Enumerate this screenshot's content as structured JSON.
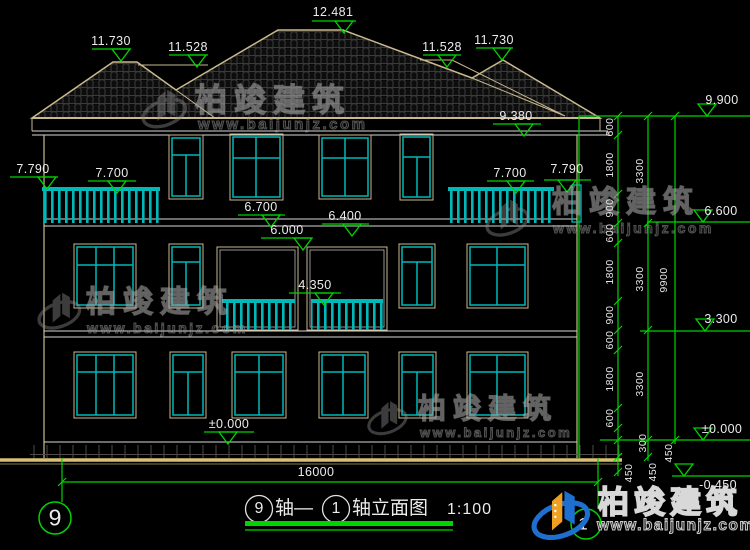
{
  "title_block": {
    "axis_left_bubble": "9",
    "axis_right_bubble": "1",
    "title_bubble_left": "9",
    "title_mid": "轴—",
    "title_bubble_right": "1",
    "title_suffix": "轴立面图",
    "scale": "1:100"
  },
  "dimensions": {
    "overall_width": "16000",
    "right_chain_inner": [
      "600",
      "1800",
      "900",
      "600",
      "1800",
      "900",
      "600",
      "1800",
      "600",
      "300"
    ],
    "right_chain_floors": [
      "3300",
      "3300",
      "3300"
    ],
    "right_chain_total": "9900",
    "below_zero": [
      "450",
      "450",
      "450"
    ]
  },
  "elevations": {
    "ridge": "12.481",
    "left_wing_ridge": "11.730",
    "left_upper_eave": "11.528",
    "right_upper_eave": "11.528",
    "right_wing_ridge": "11.730",
    "parapet_right": "9.900",
    "eave": "9.380",
    "balcony_left_rail": "7.790",
    "balcony_left_floor": "7.700",
    "balcony_right_floor": "7.700",
    "balcony_right_rail": "7.790",
    "window_sill_3f": "6.700",
    "beam_bottom_3f": "6.400",
    "floor_3f": "6.600",
    "lintel_2f": "6.000",
    "railing_2f": "4.350",
    "floor_2f": "3.300",
    "ground_floor_left": "±0.000",
    "ground_floor_right": "±0.000",
    "site_level": "-0.450"
  },
  "watermark": {
    "brand": "柏竣建筑",
    "url": "www.baijunjz.com"
  },
  "footer_logo": {
    "brand": "柏竣建筑",
    "url": "www.baijunjz.com"
  },
  "colors": {
    "background": "#000000",
    "outline_tan": "#c9b98c",
    "window_cyan": "#00b8b8",
    "dimension_green": "#00d400",
    "text_white": "#ececec",
    "ground_tan": "#d8c070",
    "logo_blue": "#1f6fd0",
    "logo_orange": "#f0a020"
  }
}
